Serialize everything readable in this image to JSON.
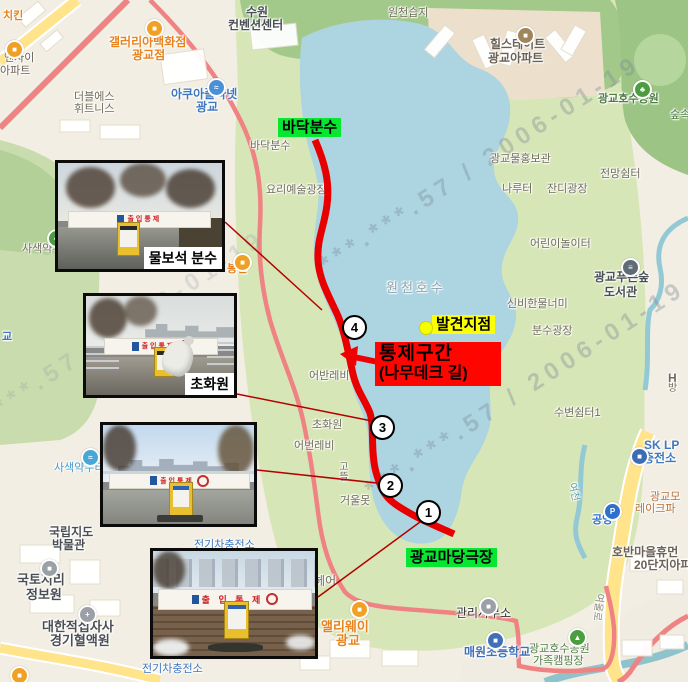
{
  "map": {
    "watermark": "***.***.57 / 2006-01-19",
    "colors": {
      "route_red": "#e80000",
      "control_box_bg": "#fe0500",
      "highlight_green": "#07e732",
      "highlight_yellow": "#fcff00",
      "lake_blue": "#acd4e1",
      "park_green": "#d7e6b6"
    },
    "labels": [
      {
        "t": "치킨",
        "x": 3,
        "y": 11,
        "c": "#e8821e",
        "s": 11,
        "b": 1
      },
      {
        "t": "앤자이",
        "x": 4,
        "y": 53,
        "c": "#6b6156",
        "s": 11
      },
      {
        "t": "아파트",
        "x": 0,
        "y": 66,
        "c": "#6b6156",
        "s": 11
      },
      {
        "t": "더블에스",
        "x": 74,
        "y": 92,
        "c": "#6f6b5a",
        "s": 11
      },
      {
        "t": "휘트니스",
        "x": 74,
        "y": 104,
        "c": "#6f6b5a",
        "s": 11
      },
      {
        "t": "갤러리아백화점",
        "x": 109,
        "y": 36,
        "c": "#e8821e",
        "s": 12,
        "b": 1
      },
      {
        "t": "광교점",
        "x": 132,
        "y": 49,
        "c": "#e8821e",
        "s": 12,
        "b": 1
      },
      {
        "t": "수원",
        "x": 246,
        "y": 6,
        "c": "#4a4f55",
        "s": 12,
        "b": 1
      },
      {
        "t": "컨벤션센터",
        "x": 228,
        "y": 19,
        "c": "#4a4f55",
        "s": 12,
        "b": 1
      },
      {
        "t": "아쿠아플라넷",
        "x": 171,
        "y": 88,
        "c": "#3e77c0",
        "s": 12,
        "b": 1
      },
      {
        "t": "광교",
        "x": 196,
        "y": 101,
        "c": "#3e77c0",
        "s": 12,
        "b": 1
      },
      {
        "t": "원천습지",
        "x": 388,
        "y": 8,
        "c": "#6f6b5a",
        "s": 11
      },
      {
        "t": "힐스테이트",
        "x": 490,
        "y": 38,
        "c": "#6b6156",
        "s": 12,
        "b": 1
      },
      {
        "t": "광교아파트",
        "x": 488,
        "y": 52,
        "c": "#6b6156",
        "s": 12,
        "b": 1
      },
      {
        "t": "광교호수공원",
        "x": 598,
        "y": 94,
        "c": "#4f7d44",
        "s": 11,
        "b": 1
      },
      {
        "t": "숲속",
        "x": 670,
        "y": 110,
        "c": "#4f7d44",
        "s": 11
      },
      {
        "t": "광교물홍보관",
        "x": 490,
        "y": 154,
        "c": "#6f6b5a",
        "s": 11
      },
      {
        "t": "전망쉼터",
        "x": 600,
        "y": 169,
        "c": "#6f6b5a",
        "s": 11
      },
      {
        "t": "나루터",
        "x": 502,
        "y": 184,
        "c": "#6f6b5a",
        "s": 11
      },
      {
        "t": "잔디광장",
        "x": 547,
        "y": 184,
        "c": "#6f6b5a",
        "s": 11
      },
      {
        "t": "어린이놀이터",
        "x": 530,
        "y": 239,
        "c": "#6f6b5a",
        "s": 11
      },
      {
        "t": "광교푸른숲",
        "x": 594,
        "y": 271,
        "c": "#4a4f55",
        "s": 12,
        "b": 1
      },
      {
        "t": "도서관",
        "x": 604,
        "y": 286,
        "c": "#4a4f55",
        "s": 12,
        "b": 1
      },
      {
        "t": "신비한물너미",
        "x": 507,
        "y": 299,
        "c": "#6f6b5a",
        "s": 11
      },
      {
        "t": "분수광장",
        "x": 532,
        "y": 326,
        "c": "#6f6b5a",
        "s": 11
      },
      {
        "t": "수변쉼터1",
        "x": 554,
        "y": 408,
        "c": "#6f6b5a",
        "s": 11
      },
      {
        "t": "SK LP",
        "x": 644,
        "y": 439,
        "c": "#3e77c0",
        "s": 12,
        "b": 1
      },
      {
        "t": "충전소",
        "x": 643,
        "y": 452,
        "c": "#3e77c0",
        "s": 12,
        "b": 1
      },
      {
        "t": "H",
        "x": 668,
        "y": 372,
        "c": "#6f6b5a",
        "s": 12,
        "b": 1
      },
      {
        "t": "방",
        "x": 668,
        "y": 384,
        "c": "#6f6b5a",
        "s": 10
      },
      {
        "t": "광교모",
        "x": 650,
        "y": 492,
        "c": "#b4713c",
        "s": 11
      },
      {
        "t": "레이크파",
        "x": 635,
        "y": 504,
        "c": "#b4713c",
        "s": 11
      },
      {
        "t": "공영",
        "x": 592,
        "y": 515,
        "c": "#2f6fce",
        "s": 11,
        "b": 1
      },
      {
        "t": "호반마을휴먼",
        "x": 612,
        "y": 546,
        "c": "#6b6156",
        "s": 12,
        "b": 1
      },
      {
        "t": "20단지아파",
        "x": 634,
        "y": 559,
        "c": "#6b6156",
        "s": 12,
        "b": 1
      },
      {
        "t": "여천",
        "x": 576,
        "y": 482,
        "c": "#5fa0ac",
        "s": 10,
        "r": 78
      },
      {
        "t": "여울로",
        "x": 604,
        "y": 594,
        "c": "#8a8878",
        "s": 10,
        "r": 97
      },
      {
        "t": "관리사무소",
        "x": 456,
        "y": 607,
        "c": "#333333",
        "s": 12
      },
      {
        "t": "매원초등학교",
        "x": 464,
        "y": 646,
        "c": "#3f6fb7",
        "s": 12,
        "b": 1
      },
      {
        "t": "광교호수공원",
        "x": 529,
        "y": 644,
        "c": "#4f7d44",
        "s": 11
      },
      {
        "t": "가족캠핑장",
        "x": 533,
        "y": 656,
        "c": "#4f7d44",
        "s": 11
      },
      {
        "t": "앨리웨이",
        "x": 321,
        "y": 620,
        "c": "#e8821e",
        "s": 13,
        "b": 1
      },
      {
        "t": "광교",
        "x": 336,
        "y": 634,
        "c": "#e8821e",
        "s": 13,
        "b": 1
      },
      {
        "t": "온헤어",
        "x": 303,
        "y": 575,
        "c": "#6f6b5a",
        "s": 12
      },
      {
        "t": "전기차충전소",
        "x": 194,
        "y": 540,
        "c": "#3e77c0",
        "s": 11
      },
      {
        "t": "전기차충전소",
        "x": 142,
        "y": 664,
        "c": "#3e77c0",
        "s": 11
      },
      {
        "t": "국립지도",
        "x": 49,
        "y": 526,
        "c": "#4a4f55",
        "s": 12,
        "b": 1
      },
      {
        "t": "박물관",
        "x": 52,
        "y": 539,
        "c": "#4a4f55",
        "s": 12,
        "b": 1
      },
      {
        "t": "국토지리",
        "x": 17,
        "y": 573,
        "c": "#4a4f55",
        "s": 13,
        "b": 1
      },
      {
        "t": "정보원",
        "x": 26,
        "y": 588,
        "c": "#4a4f55",
        "s": 13,
        "b": 1
      },
      {
        "t": "대한적십자사",
        "x": 42,
        "y": 620,
        "c": "#4a4f55",
        "s": 13,
        "b": 1
      },
      {
        "t": "경기혈액원",
        "x": 50,
        "y": 634,
        "c": "#4a4f55",
        "s": 13,
        "b": 1
      },
      {
        "t": "사색약수터",
        "x": 22,
        "y": 244,
        "c": "#6f6b5a",
        "s": 11
      },
      {
        "t": "사색약수터",
        "x": 54,
        "y": 463,
        "c": "#3f9bd0",
        "s": 11
      },
      {
        "t": "교",
        "x": 2,
        "y": 332,
        "c": "#3e77c0",
        "s": 11,
        "b": 1
      },
      {
        "t": "봉설",
        "x": 227,
        "y": 264,
        "c": "#e8821e",
        "s": 11,
        "b": 1
      },
      {
        "t": "바닥분수",
        "x": 250,
        "y": 141,
        "c": "#6f6b5a",
        "s": 11
      },
      {
        "t": "요리예술광장",
        "x": 266,
        "y": 185,
        "c": "#6f6b5a",
        "s": 11
      },
      {
        "t": "원천호수",
        "x": 386,
        "y": 281,
        "c": "#8da2ad",
        "s": 13,
        "ls": 3
      },
      {
        "t": "어반레비",
        "x": 309,
        "y": 371,
        "c": "#6f6b5a",
        "s": 11
      },
      {
        "t": "초화원",
        "x": 312,
        "y": 420,
        "c": "#6f6b5a",
        "s": 11
      },
      {
        "t": "어번레비",
        "x": 294,
        "y": 441,
        "c": "#6f6b5a",
        "s": 11
      },
      {
        "t": "거울못",
        "x": 340,
        "y": 496,
        "c": "#6f6b5a",
        "s": 11
      },
      {
        "t": "고뜰",
        "x": 336,
        "y": 461,
        "c": "#6f6b5a",
        "s": 10,
        "v": 1
      }
    ],
    "icons": [
      {
        "n": "department-store-icon",
        "x": 145,
        "y": 19,
        "bg": "#f0a024",
        "g": "■"
      },
      {
        "n": "aquarium-icon",
        "x": 207,
        "y": 78,
        "bg": "#4a90d9",
        "g": "≈"
      },
      {
        "n": "apartment-icon",
        "x": 516,
        "y": 26,
        "bg": "#a0845c",
        "g": "■"
      },
      {
        "n": "park-tree-icon",
        "x": 633,
        "y": 80,
        "bg": "#4b9e3f",
        "g": "♣"
      },
      {
        "n": "library-icon",
        "x": 621,
        "y": 258,
        "bg": "#5f6b75",
        "g": "≡"
      },
      {
        "n": "gas-station-icon",
        "x": 630,
        "y": 447,
        "bg": "#3a6db4",
        "g": "■"
      },
      {
        "n": "parking-icon",
        "x": 603,
        "y": 502,
        "bg": "#2f6fce",
        "g": "P"
      },
      {
        "n": "campground-icon",
        "x": 568,
        "y": 628,
        "bg": "#4b9e3f",
        "g": "▲"
      },
      {
        "n": "school-icon",
        "x": 486,
        "y": 631,
        "bg": "#3f6fb7",
        "g": "■"
      },
      {
        "n": "office-icon",
        "x": 479,
        "y": 597,
        "bg": "#9aa0a6",
        "g": "■"
      },
      {
        "n": "museum-icon",
        "x": 40,
        "y": 559,
        "bg": "#9aa0a6",
        "g": "■"
      },
      {
        "n": "redcross-icon",
        "x": 78,
        "y": 605,
        "bg": "#9aa0a6",
        "g": "+"
      },
      {
        "n": "spring-water-icon",
        "x": 81,
        "y": 448,
        "bg": "#45a8d8",
        "g": "≈"
      },
      {
        "n": "park-tree-icon",
        "x": 47,
        "y": 229,
        "bg": "#4b9e3f",
        "g": "♣"
      },
      {
        "n": "shopping-icon",
        "x": 350,
        "y": 600,
        "bg": "#f0a024",
        "g": "■"
      },
      {
        "n": "restaurant-icon",
        "x": 5,
        "y": 40,
        "bg": "#f0a024",
        "g": "■"
      },
      {
        "n": "restaurant-icon",
        "x": 233,
        "y": 253,
        "bg": "#f0a024",
        "g": "■"
      },
      {
        "n": "restaurant-icon",
        "x": 10,
        "y": 666,
        "bg": "#f0a024",
        "g": "■"
      }
    ]
  },
  "annotations": {
    "floor_fountain": "바닥분수",
    "theater": "광교마당극장",
    "discovery": "발견지점",
    "control_line1": "통제구간",
    "control_line2": "(나무데크 길)",
    "markers": [
      {
        "n": "1",
        "x": 426,
        "y": 510
      },
      {
        "n": "2",
        "x": 388,
        "y": 483
      },
      {
        "n": "3",
        "x": 380,
        "y": 425
      },
      {
        "n": "4",
        "x": 352,
        "y": 325
      }
    ]
  },
  "photos": [
    {
      "label": "물보석 분수",
      "banner": "출입통제"
    },
    {
      "label": "초화원",
      "banner": "출입통제"
    },
    {
      "label": "",
      "banner": "출입통제"
    },
    {
      "label": "",
      "banner": "출 입 통 제"
    }
  ]
}
